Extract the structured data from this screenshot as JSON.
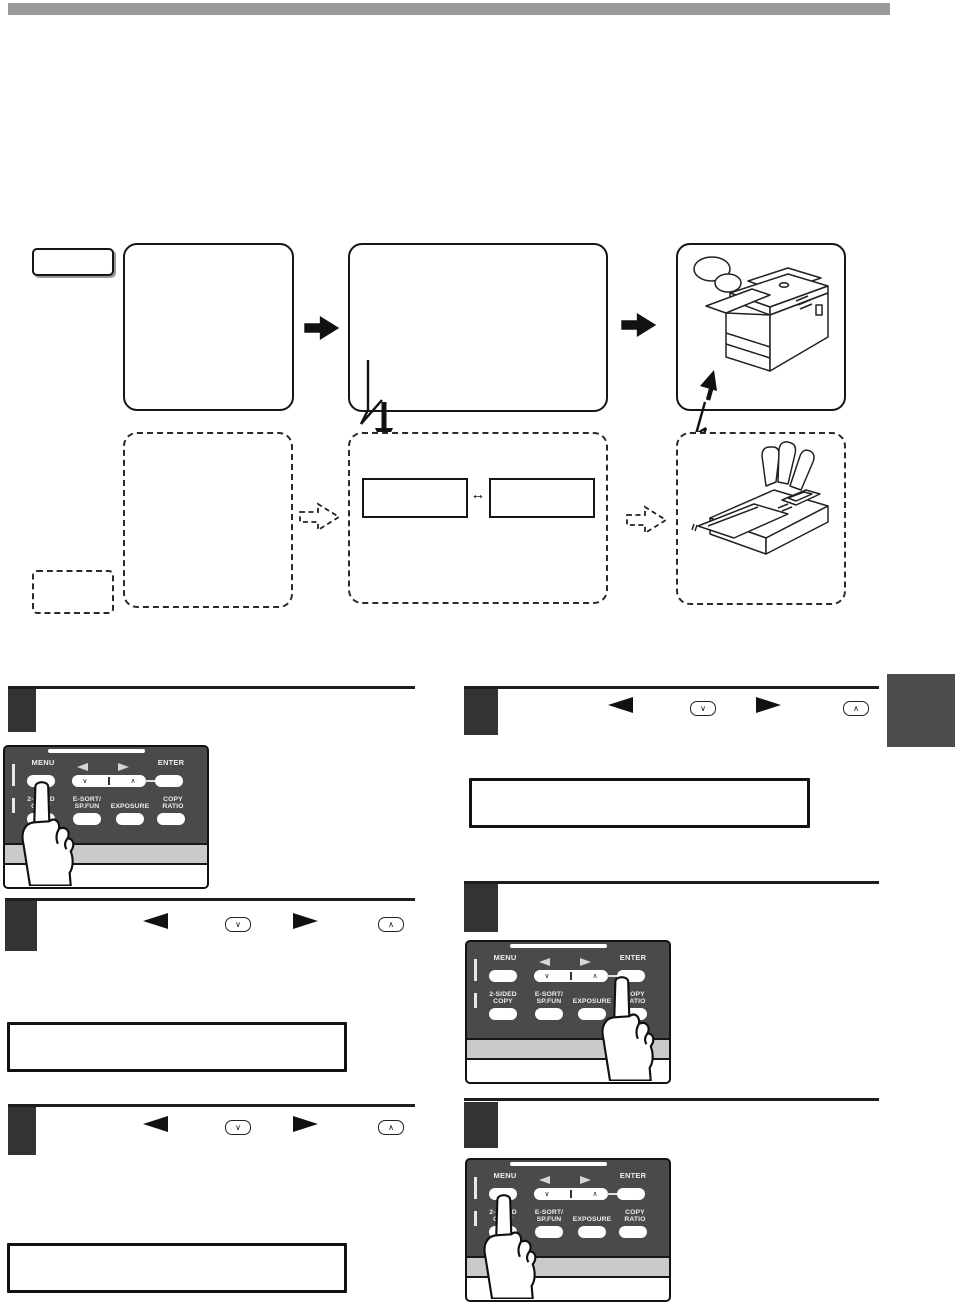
{
  "glyphs": {
    "left_arrow": "◄",
    "right_arrow": "►",
    "chevron_down": "∨",
    "chevron_up": "∧",
    "double_arrow": "↔"
  },
  "panel": {
    "menu": "MENU",
    "enter": "ENTER",
    "keys": [
      {
        "line1": "2-SIDED",
        "line2": "COPY"
      },
      {
        "line1": "E-SORT/",
        "line2": "SP.FUN"
      },
      {
        "line1": "",
        "line2": "EXPOSURE"
      },
      {
        "line1": "COPY",
        "line2": "RATIO"
      }
    ]
  },
  "colors": {
    "top_bar": "#9a9a9a",
    "step_badge": "#333333",
    "side_tab": "#4d4d4d",
    "panel_background": "#4a4a4a",
    "panel_strip": "#cacaca"
  }
}
